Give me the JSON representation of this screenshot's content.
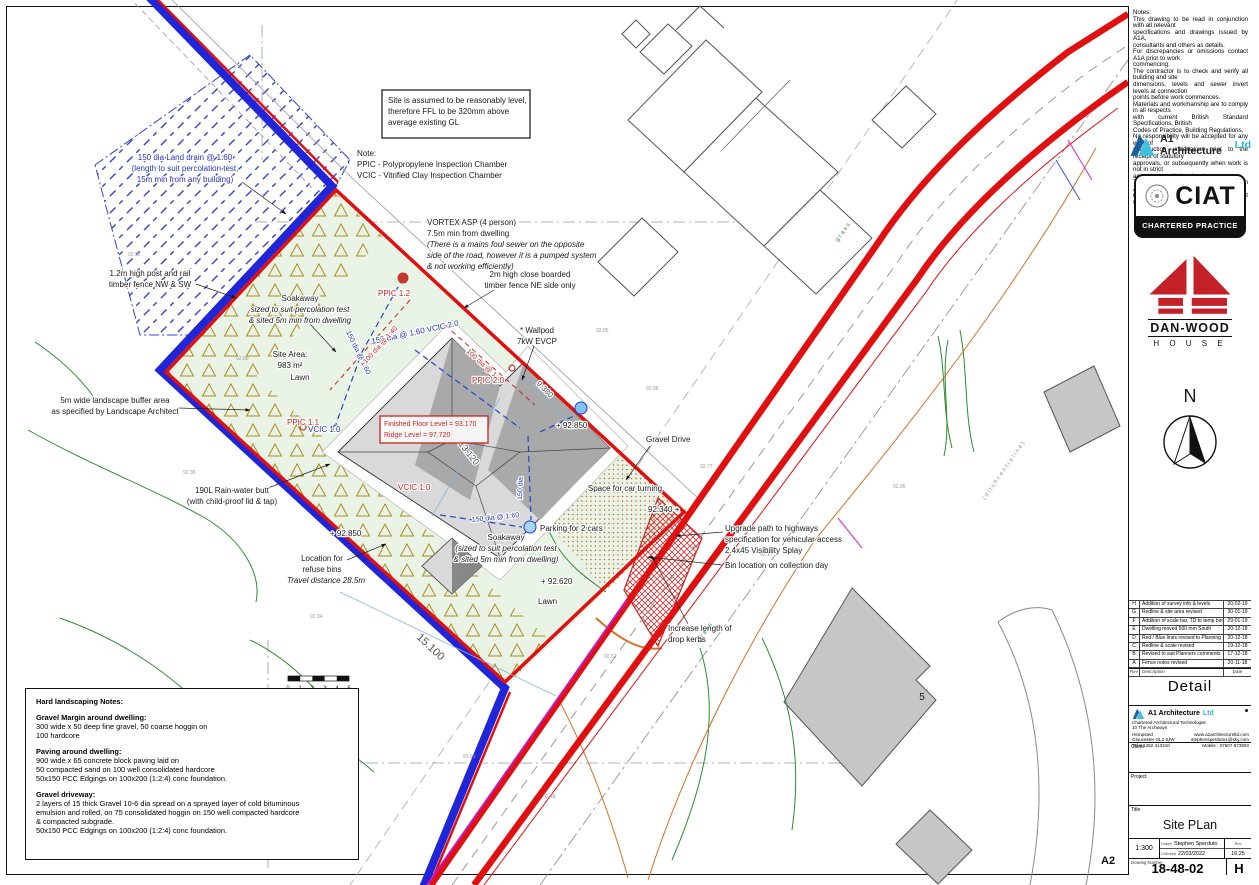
{
  "notes_panel": "Notes:\nThis drawing to be read in conjunction with all relevant\nspecifications and drawings issued by A1A,\nconsultants and others as details.\nFor discrepancies or omissions contact A1A prior to work\ncommencing.\nThe contractor is to check and verify all building and site\ndimensions, levels and sewer invert levels at connection\npoints before work commences.\nMaterials and workmanship are to comply in all respects\nwith current British Standard Specifications, British\nCodes of Practice, Building Regulations.\nNo responsibility will be accepted for any work of\nconstruction undertaken prior to the receipt of statutory\napprovals, or subsequently when work is not in strict\naccordance with the drawings.\nThe copyright of this drawing is vested in A1A and must\nnot be copied or reproduced without written consent.",
  "logos": {
    "a1_name": "A1 Architecture",
    "a1_ltd": "Ltd",
    "ciat": "CIAT",
    "ciat_sub": "CHARTERED PRACTICE",
    "danwood": "DAN-WOOD",
    "danwood_sub": "H O U S E"
  },
  "north": "N",
  "revisions": {
    "header": {
      "rev": "Rev",
      "desc": "Description",
      "date": "Date"
    },
    "rows": [
      {
        "rev": "H",
        "desc": "Addition of survey info & levels",
        "date": "20-02-19"
      },
      {
        "rev": "G",
        "desc": "Redline & site area revised",
        "date": "30-01-19"
      },
      {
        "rev": "F",
        "desc": "Addition of scale bar, TD to temp bins",
        "date": "29-01-19"
      },
      {
        "rev": "E",
        "desc": "Dwelling moved 500 mm South",
        "date": "20-12-18"
      },
      {
        "rev": "D",
        "desc": "Red / Blue lines revised to Planning",
        "date": "20-12-18"
      },
      {
        "rev": "C",
        "desc": "Redline & scale revised",
        "date": "19-12-18"
      },
      {
        "rev": "B",
        "desc": "Revised to suit Planners comments",
        "date": "17-12-18"
      },
      {
        "rev": "A",
        "desc": "Fence notes revised",
        "date": "20-11-18"
      }
    ]
  },
  "detail_label": "Detail",
  "firm": {
    "name": "A1 Architecture",
    "ltd": "Ltd",
    "tagline": "Chartered Architectural Technologist",
    "address": "10 The Archways",
    "town": "Hempsted",
    "city": "Gloucester GL2 5JW",
    "tel": "Tel 0 1452 413310",
    "web": "www.a1architectureltd.com",
    "email": "stephensperduto1@sky.com",
    "mobile": "Mobile : 07507 873903"
  },
  "fields": {
    "client_label": "Client",
    "project_label": "Project",
    "title_label": "Title",
    "drawing_title": "Site PLan",
    "scale_label": "Scale",
    "scale": "1:300",
    "drawn_label": "Drawn",
    "drawn": "Stephen Sperduto",
    "checked_label": "Checked",
    "date": "22/03/2022",
    "rev_label": "Rev",
    "time": "16:25",
    "number_label": "Drawing Number",
    "number": "18-48-02",
    "revision": "H",
    "paper_size": "A2"
  },
  "hard_notes": {
    "heading": "Hard landscaping Notes:",
    "s1h": "Gravel Margin around dwelling:",
    "s1b": "300 wide x 50 deep fine gravel, 50 coarse hoggin on\n100 hardcore",
    "s2h": "Paving around dwelling:",
    "s2b": "900 wide x 65 concrete block paving laid on\n50 compacted sand on 100 well consolidated hardcore\n50x150 PCC Edgings on 100x200 (1:2:4) conc foundation.",
    "s3h": "Gravel driveway:",
    "s3b": "2 layers of 15 thick Gravel 10-6 dia spread on a sprayed layer of cold bituminous\nemulsion and rolled, on 75 consolidated hoggin on 150 well compacted hardcore\n& compacted subgrade.\n50x150 PCC Edgings on 100x200 (1:2:4) conc foundation."
  },
  "labels": {
    "land_drain": [
      "150 dia Land drain @ 1:60",
      "(length to suit percolation test,",
      "15m min from any building)"
    ],
    "site_note": [
      "Site is assumed to be reasonably level,",
      "therefore FFL to be 320mm above",
      "average existing GL"
    ],
    "chamber_note": [
      "Note:",
      "PPIC - Polypropylene Inspection Chamber",
      "VCIC - Vitrified Clay Inspection Chamber"
    ],
    "vortex": [
      "VORTEX ASP (4 person)",
      "7.5m min from dwelling",
      "(There is a mains foul sewer on the opposite",
      "side of the road, however it is a pumped system",
      "& not working efficiently)"
    ],
    "fence_nw": [
      "1.2m high post and rail",
      "timber fence NW & SW"
    ],
    "soakaway_nw": [
      "Soakaway",
      "sized to suit percolation test",
      "& sited 5m min from dwelling"
    ],
    "fence_ne": [
      "2m high close boarded",
      "timber fence NE side only"
    ],
    "ppic12": "PPIC 1.2",
    "wallpod": [
      "* Wallpod",
      "7kW EVCP"
    ],
    "drain_vcic20": "150 dia @ 1:60  VCIC 2.0",
    "site_area": [
      "Site Area:",
      "983 m²"
    ],
    "lawn1": "Lawn",
    "ppic20": "PPIC 2.0",
    "spot_92850a": "+ 92.850",
    "gravel_drive": "Gravel Drive",
    "buffer": [
      "5m wide landscape buffer area",
      "as specified by Landscape Architect"
    ],
    "ppic11": "PPIC 1.1",
    "vcic10_blue": "VCIC 1.0",
    "ffl": [
      "Finished Floor Level = 93.170",
      "Ridge Level           = 97.720"
    ],
    "space_car": "Space for car turning",
    "rainbutt": [
      "190L Rain-water butt",
      "(with child-proof lid & tap)"
    ],
    "spot_92340": "92.340 +",
    "vcic10_red": "VCIC 1.0",
    "spot_92850b": "+ 92.850",
    "soakaway_s": [
      "Soakaway",
      "(sized to suit percolation test",
      "& sited 5m min from dwelling)"
    ],
    "parking": "Parking for 2 cars",
    "drain_150_60": "150 dia @ 1:60",
    "drain_150": "150 dia",
    "drain_150b": "150 dia @ 1:60",
    "drain_100a": "100 dia @ 1:40",
    "drain_100b": "100 dia @ 1:40",
    "upgrade": [
      "Upgrade path to highways",
      "specification for vehicular access",
      "2.4x45 Visibility Splay"
    ],
    "bin_loc": "Bin location on collection day",
    "spot_92620": "+ 92.620",
    "lawn2": "Lawn",
    "refuse": [
      "Location for",
      "refuse bins"
    ],
    "travel": "Travel distance 28.5m",
    "kerbs": [
      "Increase length of",
      "drop kerbs"
    ],
    "dim_15100": "15.100",
    "dim_13120": "13.120",
    "dim_9380": "9.380",
    "house5": "5",
    "scalebar": [
      "0",
      "1",
      "2",
      "3",
      "4",
      "5"
    ],
    "grass1": "g r a s s",
    "grass2": "g r a s s",
    "ditch": "( d i t c h   c e n t r e l i n e )"
  },
  "spots": [
    "92.92",
    "92.86",
    "92.36",
    "92.34",
    "92.85",
    "92.88",
    "92.77",
    "92.52",
    "92.17",
    "92.05",
    "91.95",
    "92.48",
    "92.35",
    "92.31"
  ],
  "colors": {
    "boundary_red": "#e01010",
    "ownership_blue": "#2026d8",
    "lawn_green": "#eaf4e6",
    "gravel_dot": "#b9672f",
    "contour_green": "#2e8b2e",
    "danwood_red": "#c42027",
    "a1_cyan": "#29b6d8"
  }
}
